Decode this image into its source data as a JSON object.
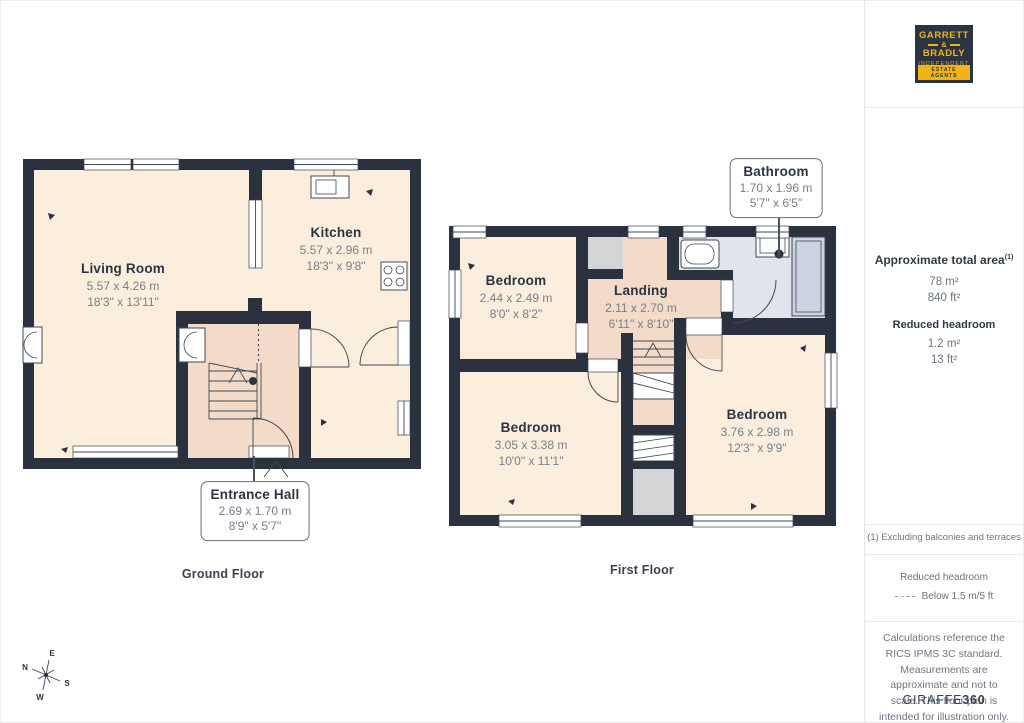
{
  "logo": {
    "line1": "GARRETT",
    "amp": "&",
    "line2": "BRADLY",
    "tagline": "INDEPENDENT",
    "banner": "ESTATE AGENTS"
  },
  "sidebar": {
    "total_area_title": "Approximate total area",
    "total_area_footnote_marker": "(1)",
    "total_area_m": "78 m²",
    "total_area_ft": "840 ft²",
    "reduced_headroom_title": "Reduced headroom",
    "reduced_headroom_m": "1.2 m²",
    "reduced_headroom_ft": "13 ft²",
    "footnote": "(1) Excluding balconies and terraces",
    "legend_title": "Reduced headroom",
    "legend_value": "Below 1.5 m/5 ft",
    "disclaimer": "Calculations reference the RICS IPMS 3C standard. Measurements are approximate and not to scale. This floor plan is intended for illustration only.",
    "brand_name": "GIRAFFE",
    "brand_suffix": "360"
  },
  "ground_floor": {
    "label": "Ground Floor",
    "rooms": {
      "living": {
        "name": "Living Room",
        "metric": "5.57 x 4.26 m",
        "imperial": "18'3\" x 13'11\""
      },
      "kitchen": {
        "name": "Kitchen",
        "metric": "5.57 x 2.96 m",
        "imperial": "18'3\" x 9'8\""
      },
      "hall": {
        "name": "Entrance Hall",
        "metric": "2.69 x 1.70 m",
        "imperial": "8'9\" x 5'7\""
      }
    }
  },
  "first_floor": {
    "label": "First Floor",
    "rooms": {
      "bedroom1": {
        "name": "Bedroom",
        "metric": "2.44 x 2.49 m",
        "imperial": "8'0\" x 8'2\""
      },
      "landing": {
        "name": "Landing",
        "metric": "2.11 x 2.70 m",
        "imperial": "6'11\" x 8'10\""
      },
      "bathroom": {
        "name": "Bathroom",
        "metric": "1.70 x 1.96 m",
        "imperial": "5'7\" x 6'5\""
      },
      "bedroom2": {
        "name": "Bedroom",
        "metric": "3.05 x 3.38 m",
        "imperial": "10'0\" x 11'1\""
      },
      "bedroom3": {
        "name": "Bedroom",
        "metric": "3.76 x 2.98 m",
        "imperial": "12'3\" x 9'9\""
      }
    }
  },
  "compass": {
    "n": "N",
    "e": "E",
    "s": "S",
    "w": "W"
  },
  "colors": {
    "wall": "#2a313f",
    "room": "#fceedd",
    "hall": "#f3dac9",
    "bathroom": "#dfe4ed",
    "closet": "#d3d4d6",
    "logo_bg": "#2b3442",
    "logo_yellow": "#f0b417"
  }
}
